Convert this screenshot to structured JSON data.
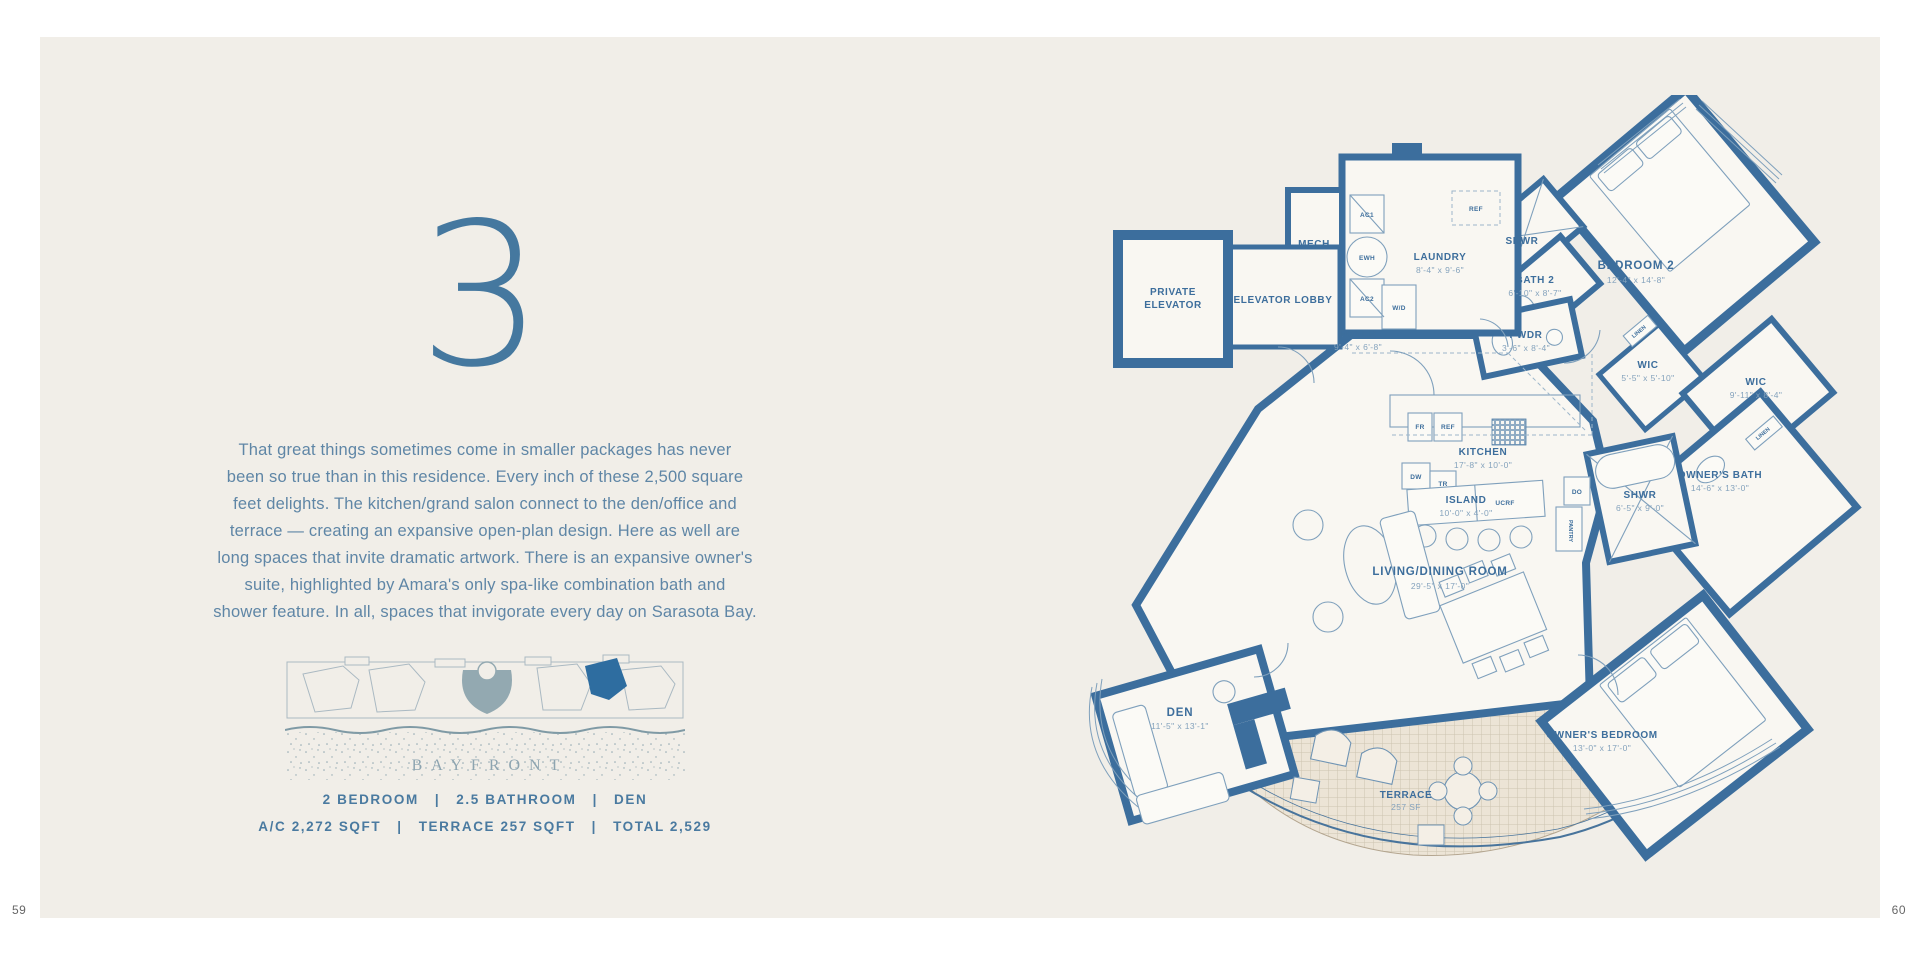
{
  "page": {
    "left_number": "59",
    "right_number": "60"
  },
  "left": {
    "residence_number": "3",
    "description_lines": [
      "That great things sometimes come in smaller packages has never",
      "been so true than in this residence. Every inch of these 2,500 square",
      "feet delights. The kitchen/grand salon connect to the den/office and",
      "terrace — creating an expansive open-plan design. Here as well are",
      "long spaces that invite dramatic artwork. There is an expansive owner's",
      "suite, highlighted by Amara's only spa-like combination bath and",
      "shower feature. In all, spaces that invigorate every day on Sarasota Bay."
    ],
    "site_plan": {
      "area_label": "BAYFRONT"
    },
    "specs_line1": "2 BEDROOM   |   2.5 BATHROOM   |   DEN",
    "specs_line2": "A/C 2,272 SQFT   |   TERRACE 257 SQFT   |   TOTAL 2,529"
  },
  "plan": {
    "colors": {
      "wall": "#3c6e9d",
      "highlight_unit": "#2e6da0"
    },
    "rooms": [
      {
        "line1": "PRIVATE",
        "line2": "ELEVATOR"
      },
      {
        "name": "ELEVATOR LOBBY"
      },
      {
        "name": "MECH"
      },
      {
        "name": "LAUNDRY",
        "dims": "8'-4\" x 9'-6\""
      },
      {
        "name": "FOYER",
        "dims": "9'-4\" x 6'-8\""
      },
      {
        "name": "SHWR"
      },
      {
        "name": "BATH 2",
        "dims": "6'-10\" x 8'-7\""
      },
      {
        "name": "BEDROOM 2",
        "dims": "12'-4\" x 14'-8\""
      },
      {
        "name": "PWDR",
        "dims": "3'-6\" x 8'-4\""
      },
      {
        "name": "WIC",
        "dims": "5'-5\" x 5'-10\""
      },
      {
        "name": "WIC",
        "dims": "9'-11\" x 8'-4\""
      },
      {
        "name": "KITCHEN",
        "dims": "17'-8\" x 10'-0\""
      },
      {
        "name": "ISLAND",
        "dims": "10'-0\" x 4'-0\""
      },
      {
        "name": "SHWR",
        "dims": "6'-5\" x 9'-0\""
      },
      {
        "name": "OWNER'S BATH",
        "dims": "14'-6\" x 13'-0\""
      },
      {
        "name": "LIVING/DINING ROOM",
        "dims": "29'-5\" x 17'-0\""
      },
      {
        "name": "DEN",
        "dims": "11'-5\" x 13'-1\""
      },
      {
        "name": "OWNER'S BEDROOM",
        "dims": "13'-0\" x 17'-0\""
      },
      {
        "name": "TERRACE",
        "dims": "257 SF"
      }
    ],
    "fixtures": [
      "AC1",
      "EWH",
      "AC2",
      "W/D",
      "REF",
      "FR",
      "REF",
      "DW",
      "TR",
      "UCRF",
      "DO",
      "PANTRY",
      "LINEN",
      "LINEN"
    ]
  }
}
